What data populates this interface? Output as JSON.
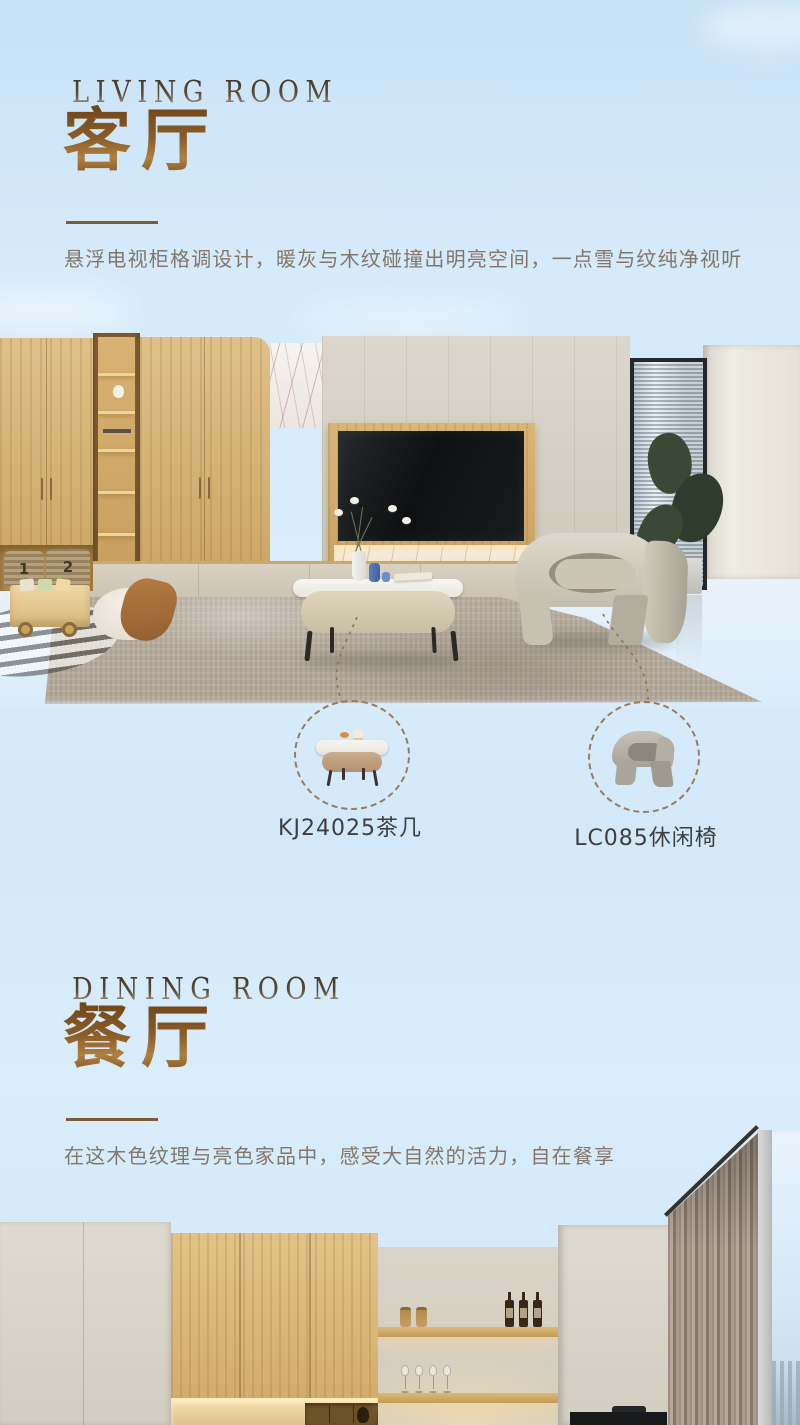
{
  "page": {
    "width": 800,
    "height": 1425
  },
  "sections": [
    {
      "eyebrow": "LIVING ROOM",
      "title": "客厅",
      "description": "悬浮电视柜格调设计，暖灰与木纹碰撞出明亮空间，一点雪与纹纯净视听"
    },
    {
      "eyebrow": "DINING ROOM",
      "title": "餐厅",
      "description": "在这木色纹理与亮色家品中，感受大自然的活力，自在餐享"
    }
  ],
  "callouts": [
    {
      "label": "KJ24025茶几",
      "item": "coffee-table"
    },
    {
      "label": "LC085休闲椅",
      "item": "lounge-chair"
    }
  ],
  "photo_text": {
    "basket_labels": [
      "1",
      "2"
    ]
  },
  "colors": {
    "accent_brown": "#7c5a34",
    "title_brown": "#8a5c28",
    "description_text": "#837769",
    "label_text": "#3f3f3f",
    "dashed_line": "#8f7255",
    "sky": "#d5eafa"
  }
}
